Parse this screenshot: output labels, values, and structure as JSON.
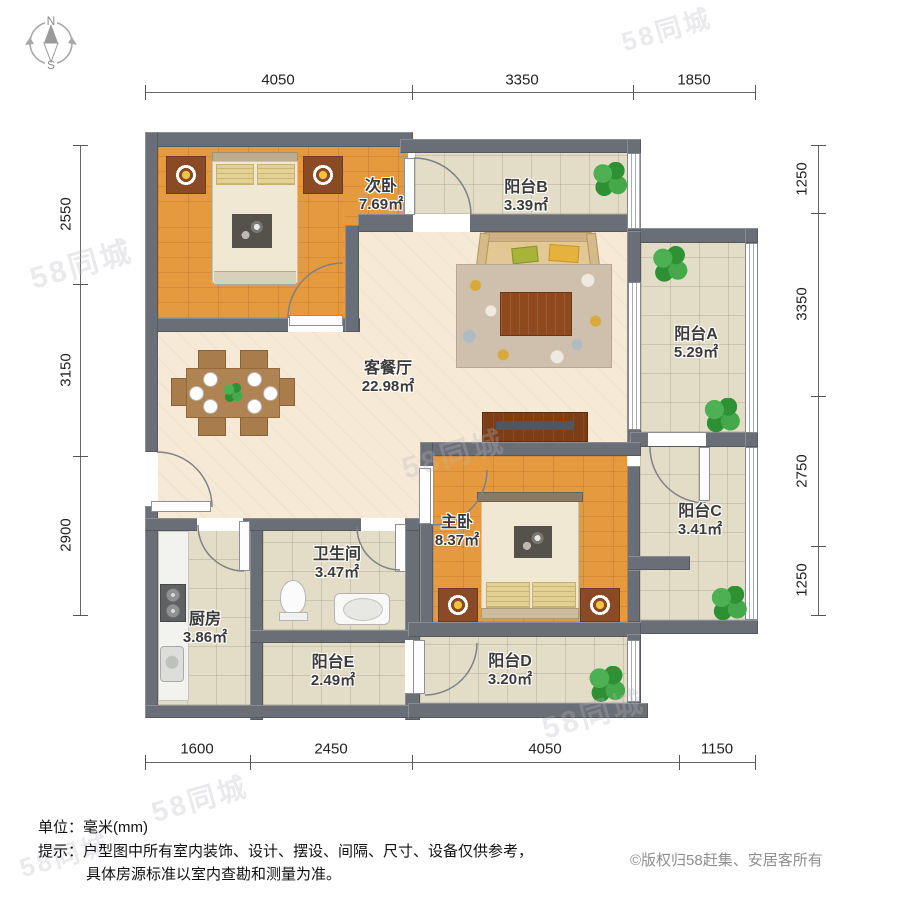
{
  "compass": {
    "north": "N",
    "south": "S"
  },
  "watermark_text": "58同城",
  "colors": {
    "wall": "#6a6e76",
    "wood_floor": "#e59a40",
    "tile_floor": "#e3ddc8",
    "main_floor": "#f6ead7",
    "plant_green": "#3aa340"
  },
  "rooms": {
    "ciwo": {
      "name": "次卧",
      "area": "7.69㎡"
    },
    "ytB": {
      "name": "阳台B",
      "area": "3.39㎡"
    },
    "keting": {
      "name": "客餐厅",
      "area": "22.98㎡"
    },
    "ytA": {
      "name": "阳台A",
      "area": "5.29㎡"
    },
    "zhuwo": {
      "name": "主卧",
      "area": "8.37㎡"
    },
    "ytC": {
      "name": "阳台C",
      "area": "3.41㎡"
    },
    "wsj": {
      "name": "卫生间",
      "area": "3.47㎡"
    },
    "chufang": {
      "name": "厨房",
      "area": "3.86㎡"
    },
    "ytE": {
      "name": "阳台E",
      "area": "2.49㎡"
    },
    "ytD": {
      "name": "阳台D",
      "area": "3.20㎡"
    }
  },
  "dims": {
    "top": [
      "4050",
      "3350",
      "1850"
    ],
    "left": [
      "2550",
      "3150",
      "2900"
    ],
    "right": [
      "1250",
      "3350",
      "2750",
      "1250"
    ],
    "bottom": [
      "1600",
      "2450",
      "4050",
      "1150"
    ]
  },
  "footer": {
    "unit": "单位：毫米(mm)",
    "tip1": "提示：户型图中所有室内装饰、设计、摆设、间隔、尺寸、设备仅供参考，",
    "tip2": "具体房源标准以室内查勘和测量为准。",
    "copyright": "©版权归58赶集、安居客所有"
  }
}
